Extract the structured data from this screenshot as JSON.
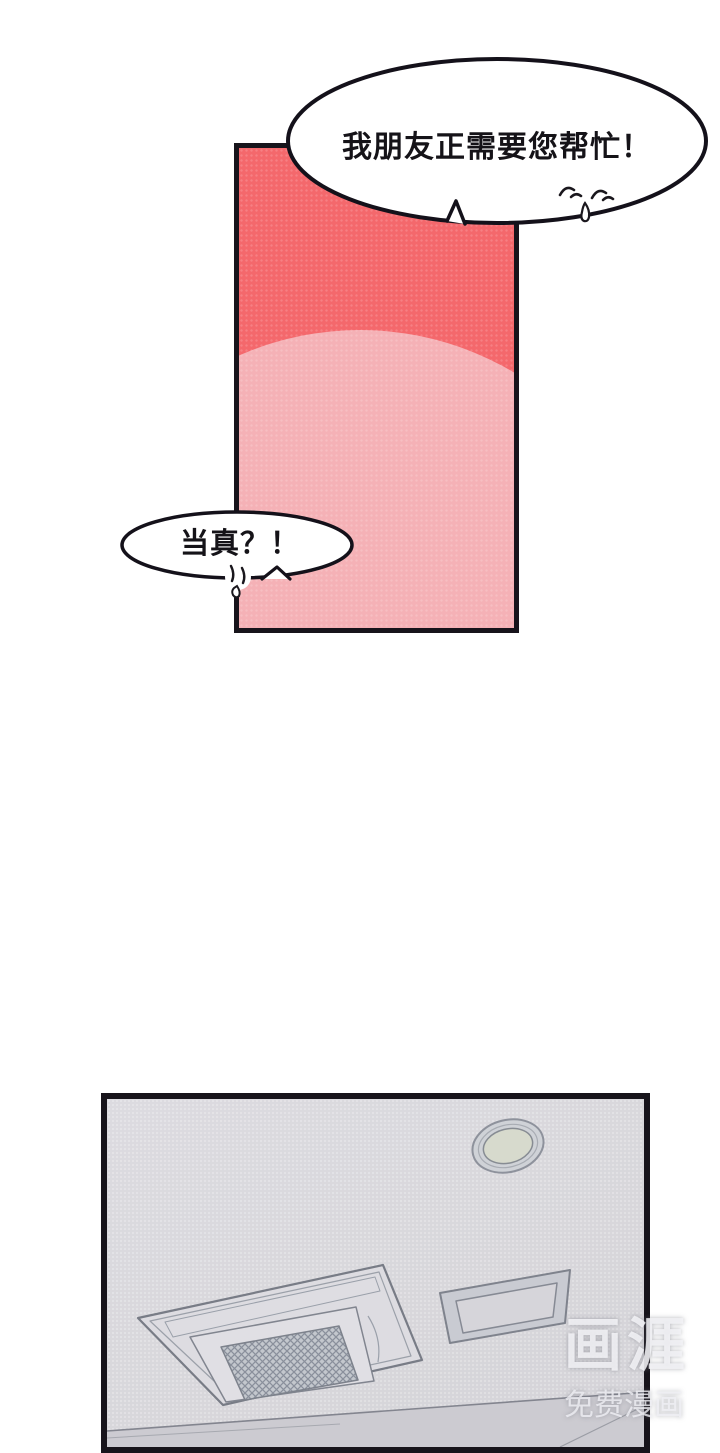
{
  "scene": {
    "type": "comic-page",
    "panel_count": 2,
    "panel1_description": "red-pink gradient background panel with speech bubbles",
    "panel2_description": "ceiling with cassette air-conditioner, vent frame and round light"
  },
  "bubbles": {
    "bubble1": {
      "text": "我朋友正需要您帮忙！"
    },
    "bubble2": {
      "text": "当真？！"
    }
  },
  "watermark": {
    "logo": "画涯",
    "tagline": "免费漫画"
  },
  "colors": {
    "panel_red": "#f4686c",
    "panel_pink": "#f5b1b6",
    "panel_border": "#17141b",
    "bubble_fill": "#ffffff",
    "bubble_stroke": "#14111a",
    "ceiling": "#d9d8dc",
    "wall": "#cccbd1",
    "line_gray": "#83858f"
  }
}
